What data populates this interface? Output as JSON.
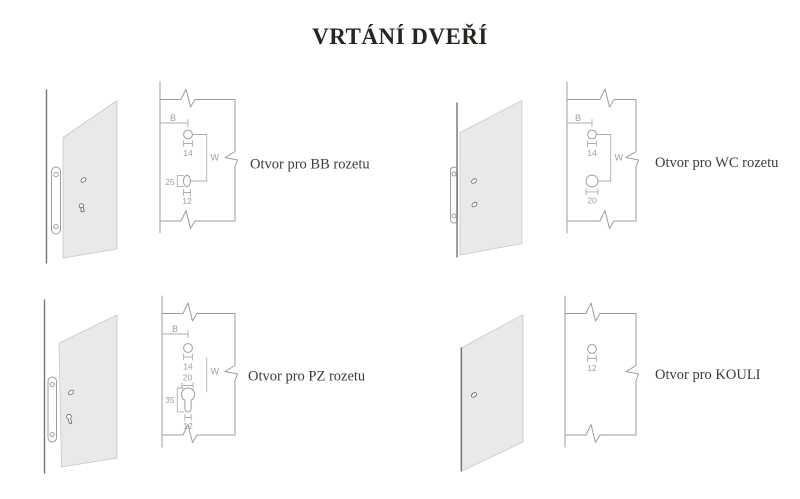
{
  "title": "VRTÁNÍ DVEŘÍ",
  "colors": {
    "background": "#ffffff",
    "title_text": "#282420",
    "label_text": "#3c3c3c",
    "dimension_text": "#9e9e9e",
    "drawing_line": "#9d9d9d",
    "door_panel_fill": "#e9e9e9",
    "door_edge_line": "#757575"
  },
  "diagrams": [
    {
      "id": "bb",
      "label": "Otvor pro BB rozetu",
      "dim_b": "B",
      "dim_w": "W",
      "handle_hole_d": "14",
      "key_slot_h": "25",
      "key_slot_w": "12"
    },
    {
      "id": "wc",
      "label": "Otvor pro WC rozetu",
      "dim_b": "B",
      "dim_w": "W",
      "handle_hole_d": "14",
      "wc_hole_d": "20"
    },
    {
      "id": "pz",
      "label": "Otvor pro PZ rozetu",
      "dim_b": "B",
      "dim_w": "W",
      "handle_hole_d": "14",
      "cylinder_hole_d": "20",
      "cylinder_slot_h": "35",
      "cylinder_slot_w": "12"
    },
    {
      "id": "kouli",
      "label": "Otvor pro KOULI",
      "knob_hole_d": "12"
    }
  ]
}
